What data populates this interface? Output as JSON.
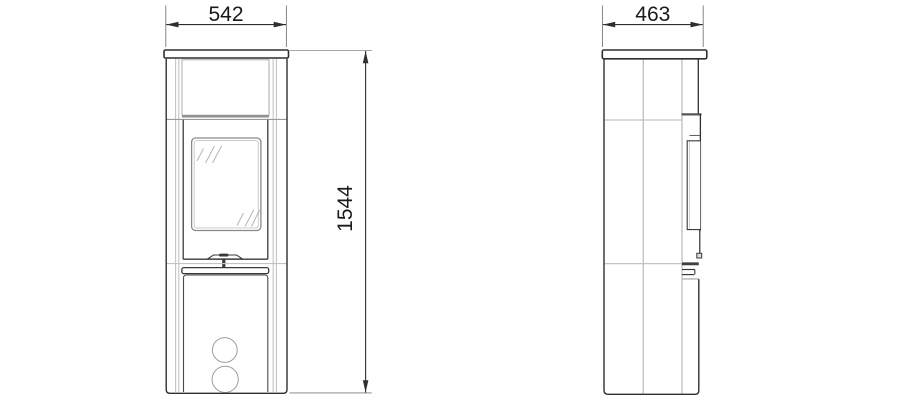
{
  "diagram": {
    "type": "technical-drawing",
    "front_view": {
      "width_label": "542",
      "height_label": "1544"
    },
    "side_view": {
      "depth_label": "463"
    }
  },
  "colors": {
    "background": "#ffffff",
    "outline": "#2f2f2f",
    "secondary_line": "#c3c3c3",
    "mid_line": "#8f8f8f",
    "dimension_text": "#1a1a1a"
  }
}
